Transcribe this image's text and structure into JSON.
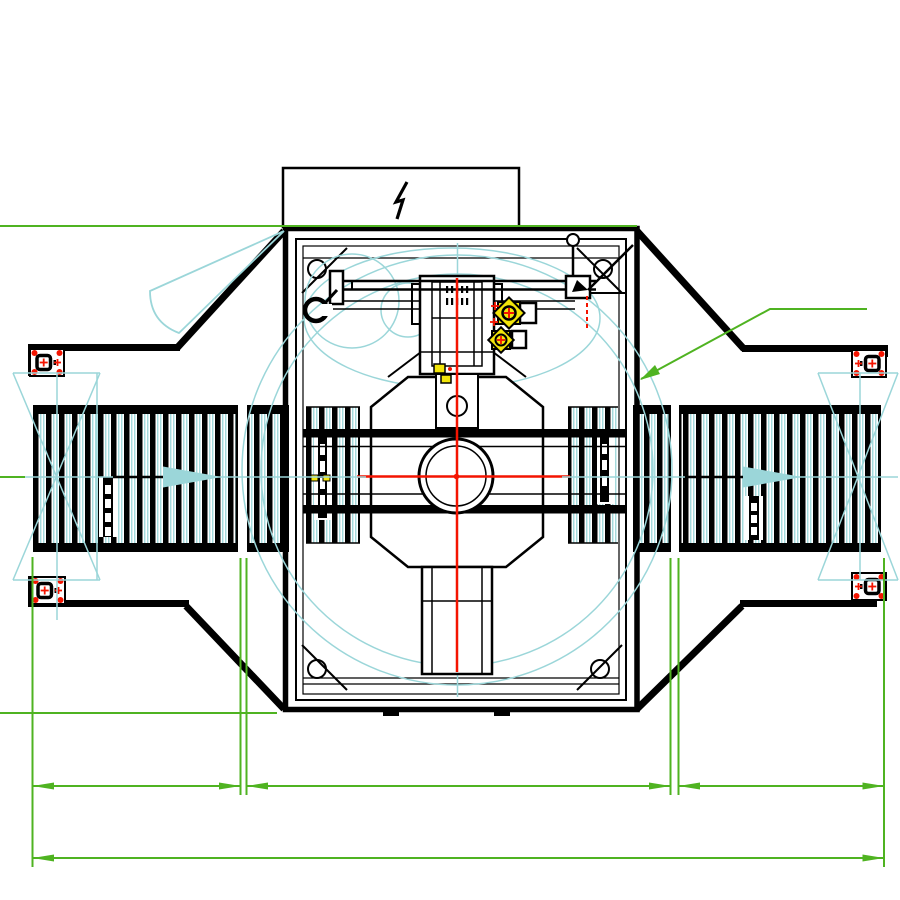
{
  "page": {
    "background": "#ffffff"
  },
  "colors": {
    "line": "#000000",
    "red": "#f41400",
    "cyan": "#9bd6d9",
    "green": "#4fb321",
    "yellow": "#f2e50a",
    "white": "#ffffff"
  },
  "drawing": {
    "type": "cad-plan-view-technical-drawing",
    "power_box_symbol": "lightning-zigzag",
    "flow_arrows": [
      {
        "location": "left-conveyor",
        "direction": "right"
      },
      {
        "location": "right-conveyor",
        "direction": "right"
      }
    ],
    "components": [
      "left-conveyor-section",
      "right-conveyor-section",
      "turntable-square-frame",
      "rotating-conveyor-segments",
      "center-bearing-ring",
      "drive-gearbox",
      "swing-arm",
      "corner-roller-blocks",
      "support-pedestal",
      "electrical-box"
    ],
    "dimension_rows": [
      {
        "y": 786,
        "segment_spans_x": [
          [
            32,
            240
          ],
          [
            246,
            670
          ],
          [
            678,
            884
          ]
        ]
      },
      {
        "y": 858,
        "segment_spans_x": [
          [
            32,
            884
          ]
        ]
      }
    ],
    "leader_line": {
      "points": "867,309 770,309 641,379"
    }
  }
}
